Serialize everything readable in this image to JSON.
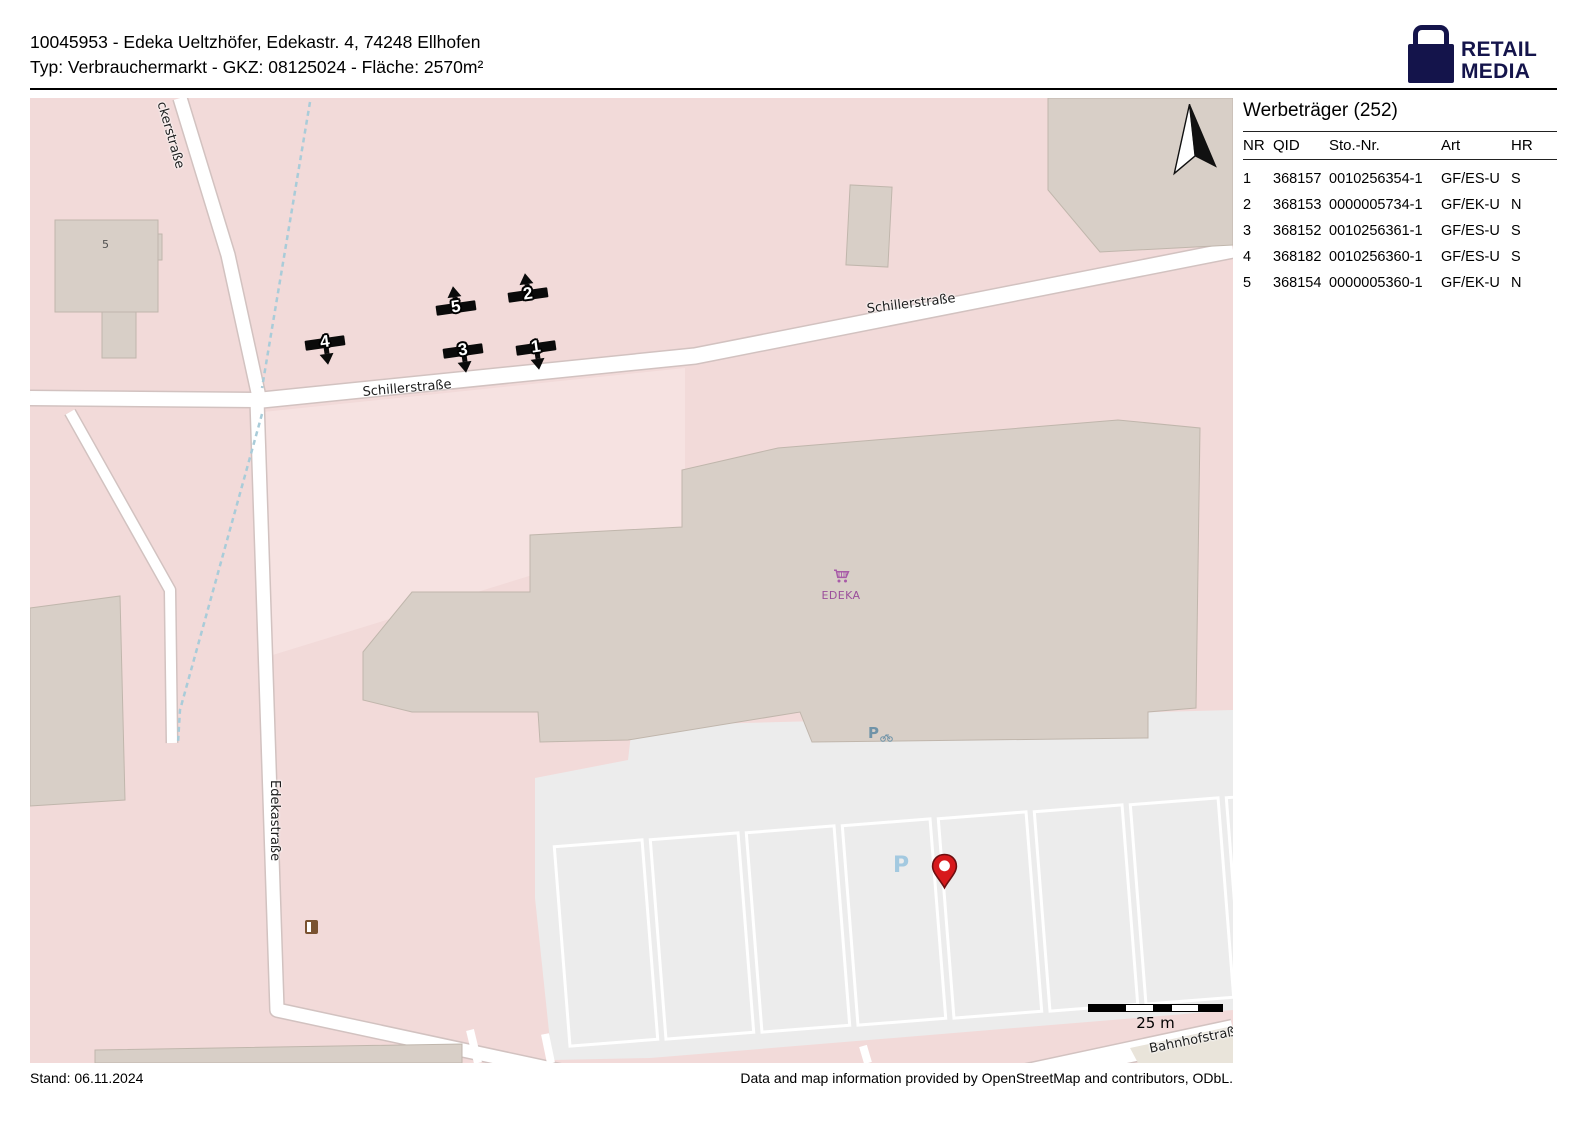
{
  "header": {
    "line1": "10045953 - Edeka Ueltzhöfer, Edekastr. 4, 74248 Ellhofen",
    "line2": "Typ: Verbrauchermarkt - GKZ: 08125024 - Fläche: 2570m²"
  },
  "logo": {
    "line1": "RETAIL",
    "line2": "MEDIA",
    "icon": "shopping-bag-icon",
    "color": "#14144b"
  },
  "panel": {
    "title": "Werbeträger (252)",
    "columns": [
      "NR",
      "QID",
      "Sto.-Nr.",
      "Art",
      "HR"
    ],
    "rows": [
      {
        "nr": "1",
        "qid": "368157",
        "sto": "0010256354-1",
        "art": "GF/ES-U",
        "hr": "S"
      },
      {
        "nr": "2",
        "qid": "368153",
        "sto": "0000005734-1",
        "art": "GF/EK-U",
        "hr": "N"
      },
      {
        "nr": "3",
        "qid": "368152",
        "sto": "0010256361-1",
        "art": "GF/ES-U",
        "hr": "S"
      },
      {
        "nr": "4",
        "qid": "368182",
        "sto": "0010256360-1",
        "art": "GF/ES-U",
        "hr": "S"
      },
      {
        "nr": "5",
        "qid": "368154",
        "sto": "0000005360-1",
        "art": "GF/EK-U",
        "hr": "N"
      }
    ]
  },
  "map": {
    "streets": {
      "eckerstrasse": "ckerstraße",
      "schillerstrasse_west": "Schillerstraße",
      "schillerstrasse_east": "Schillerstraße",
      "edekastrasse": "Edekastraße",
      "bahnhofstrasse": "Bahnhofstraße"
    },
    "building_number": "5",
    "poi": {
      "edeka_label": "EDEKA",
      "cart_icon_color": "#a85ba8"
    },
    "parking_label": "P",
    "bike_parking_label": "P",
    "markers": [
      {
        "label": "1",
        "direction": "down"
      },
      {
        "label": "2",
        "direction": "up"
      },
      {
        "label": "3",
        "direction": "down"
      },
      {
        "label": "4",
        "direction": "down"
      },
      {
        "label": "5",
        "direction": "up"
      }
    ],
    "scale": {
      "label": "25 m"
    },
    "colors": {
      "residential_pink": "#f2dad9",
      "building_beige": "#d8cfc7",
      "parking_gray": "#ececec",
      "pin_red": "#d7191c",
      "parking_blue": "#a3c9e0",
      "bike_parking_blue": "#6f93a8"
    }
  },
  "footer": {
    "left": "Stand: 06.11.2024",
    "right": "Data and map information provided by OpenStreetMap and contributors, ODbL."
  }
}
